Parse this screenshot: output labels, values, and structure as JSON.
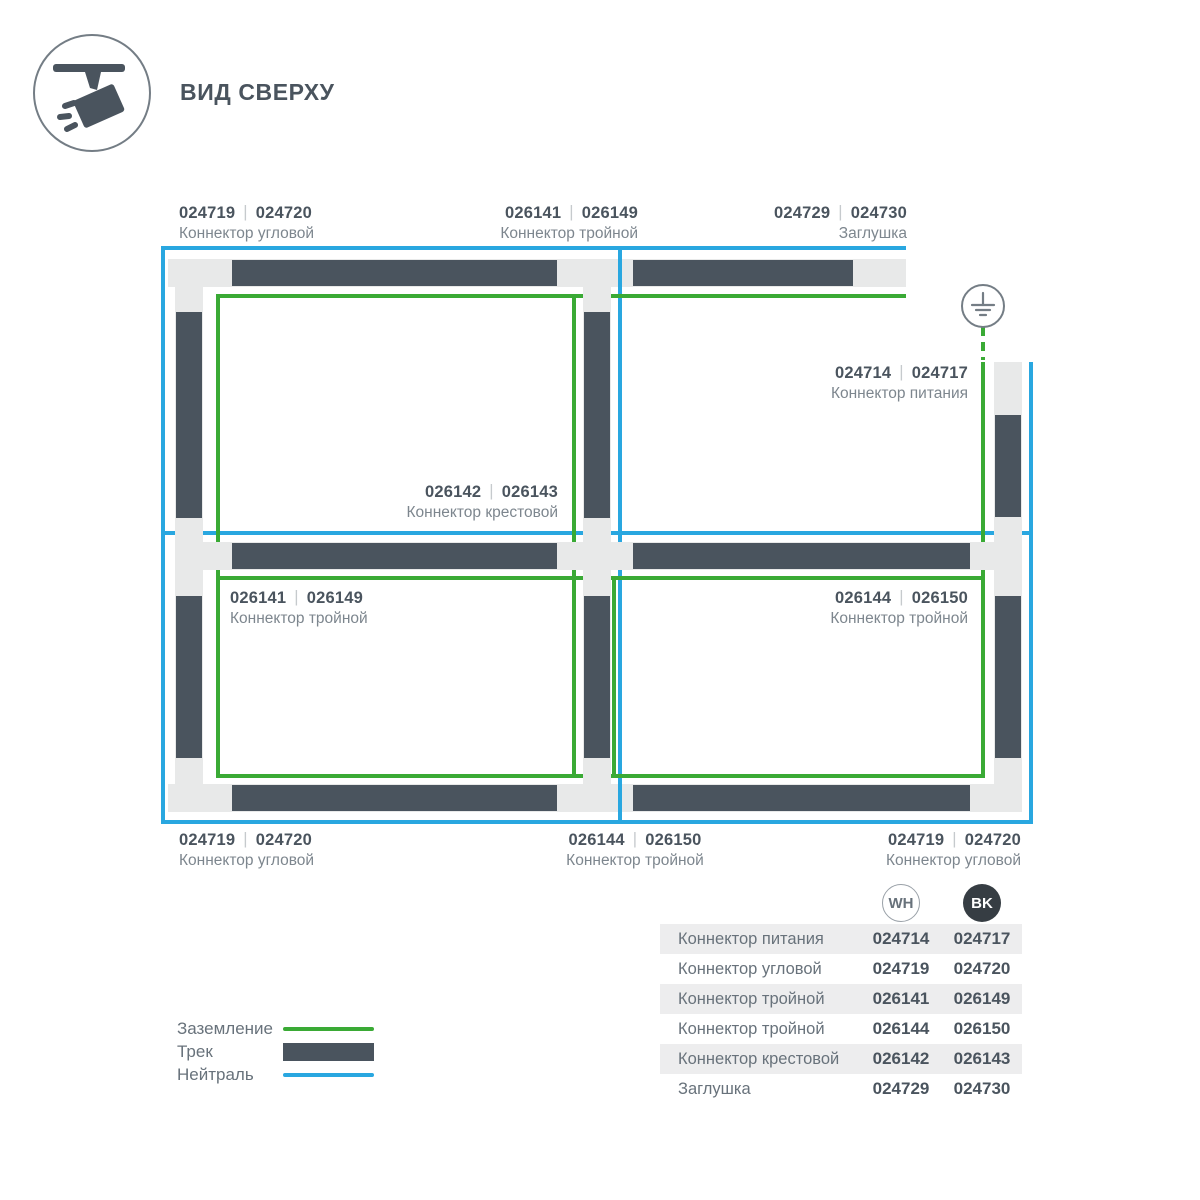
{
  "title": "ВИД СВЕРХУ",
  "separator": "|",
  "icons": {
    "header": "track-spotlight-icon",
    "ground": "earth-ground-icon"
  },
  "colors": {
    "track_dark": "#4a545e",
    "connector_light": "#e8e9e9",
    "ground_green": "#3aaa35",
    "neutral_blue": "#29a7e0"
  },
  "diagram_labels": {
    "top_left": {
      "wh": "024719",
      "bk": "024720",
      "name": "Коннектор угловой"
    },
    "top_center": {
      "wh": "026141",
      "bk": "026149",
      "name": "Коннектор тройной"
    },
    "top_right": {
      "wh": "024729",
      "bk": "024730",
      "name": "Заглушка"
    },
    "power": {
      "wh": "024714",
      "bk": "024717",
      "name": "Коннектор питания"
    },
    "cross": {
      "wh": "026142",
      "bk": "026143",
      "name": "Коннектор крестовой"
    },
    "mid_left": {
      "wh": "026141",
      "bk": "026149",
      "name": "Коннектор тройной"
    },
    "mid_right": {
      "wh": "026144",
      "bk": "026150",
      "name": "Коннектор тройной"
    },
    "bottom_left": {
      "wh": "024719",
      "bk": "024720",
      "name": "Коннектор угловой"
    },
    "bottom_center": {
      "wh": "026144",
      "bk": "026150",
      "name": "Коннектор тройной"
    },
    "bottom_right": {
      "wh": "024719",
      "bk": "024720",
      "name": "Коннектор угловой"
    }
  },
  "legend": {
    "ground": "Заземление",
    "track": "Трек",
    "neutral": "Нейтраль"
  },
  "table": {
    "col_wh": "WH",
    "col_bk": "BK",
    "rows": [
      {
        "name": "Коннектор питания",
        "wh": "024714",
        "bk": "024717"
      },
      {
        "name": "Коннектор угловой",
        "wh": "024719",
        "bk": "024720"
      },
      {
        "name": "Коннектор тройной",
        "wh": "026141",
        "bk": "026149"
      },
      {
        "name": "Коннектор тройной",
        "wh": "026144",
        "bk": "026150"
      },
      {
        "name": "Коннектор крестовой",
        "wh": "026142",
        "bk": "026143"
      },
      {
        "name": "Заглушка",
        "wh": "024729",
        "bk": "024730"
      }
    ]
  }
}
